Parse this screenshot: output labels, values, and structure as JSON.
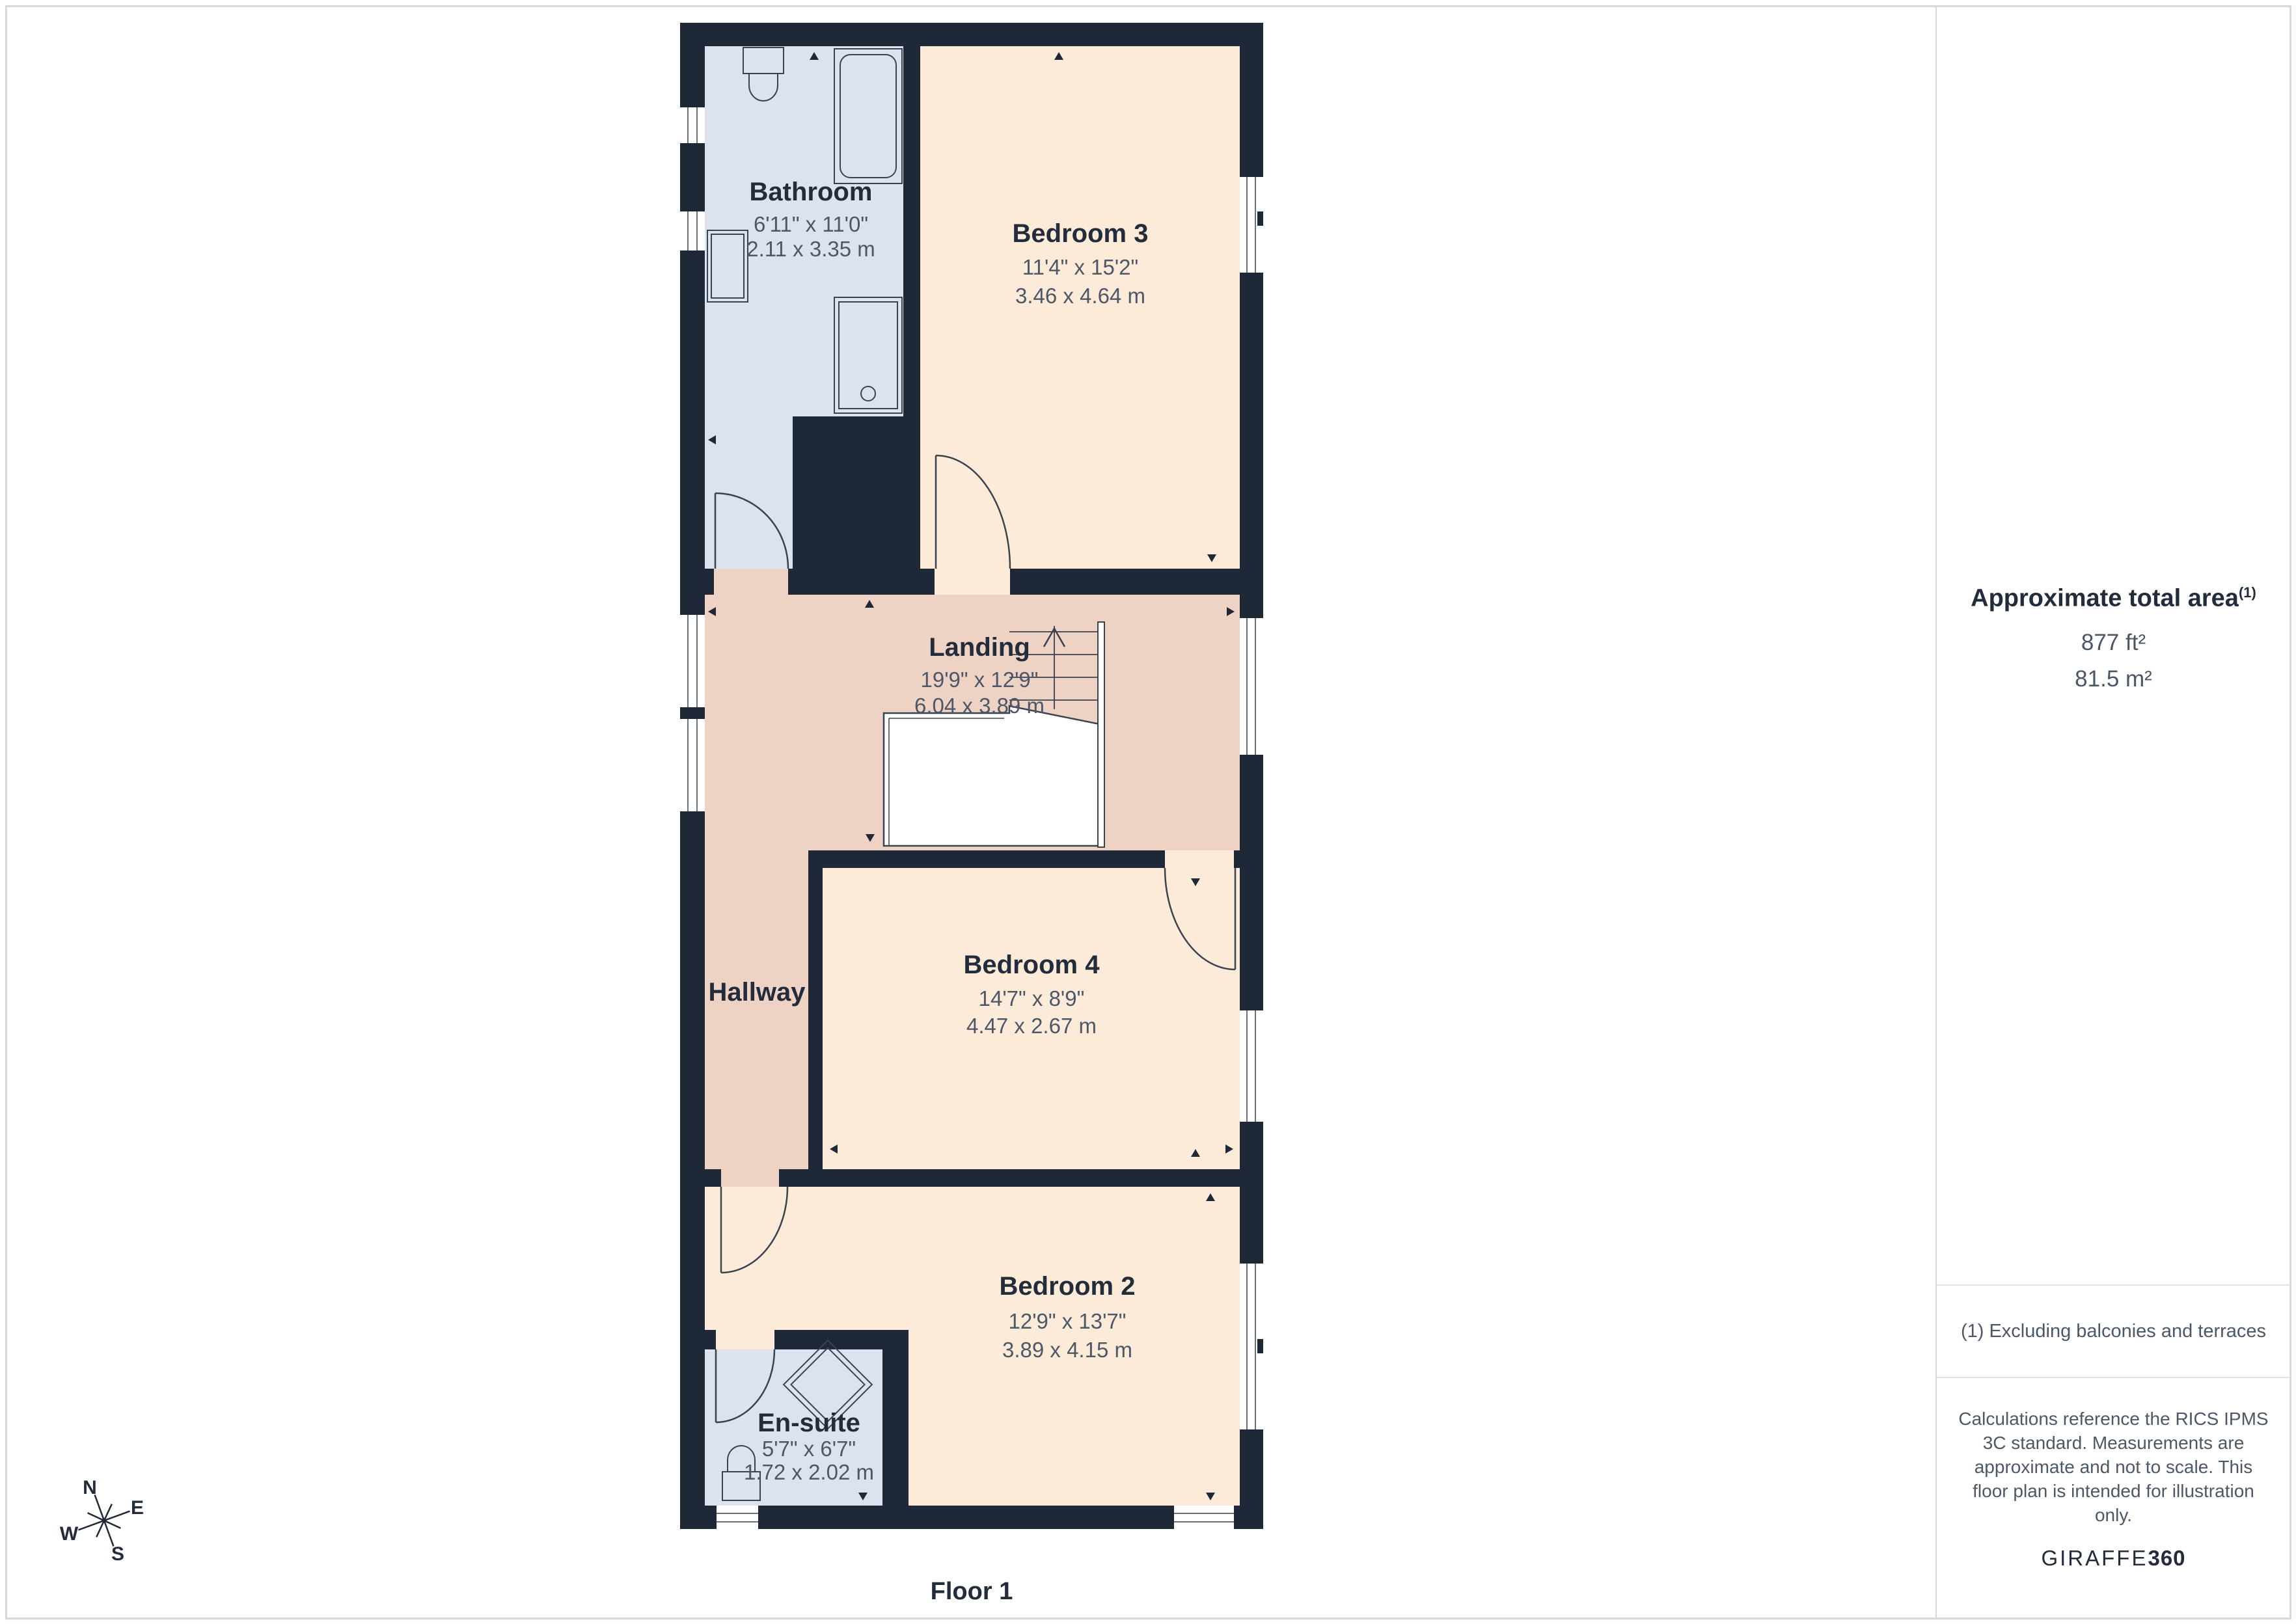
{
  "page": {
    "floor_label": "Floor 1"
  },
  "rooms": {
    "bathroom": {
      "name": "Bathroom",
      "imperial": "6'11\" x 11'0\"",
      "metric": "2.11 x 3.35 m"
    },
    "bedroom3": {
      "name": "Bedroom 3",
      "imperial": "11'4\" x 15'2\"",
      "metric": "3.46 x 4.64 m"
    },
    "landing": {
      "name": "Landing",
      "imperial": "19'9\" x 12'9\"",
      "metric": "6.04 x 3.89 m"
    },
    "hallway": {
      "name": "Hallway"
    },
    "bedroom4": {
      "name": "Bedroom 4",
      "imperial": "14'7\" x 8'9\"",
      "metric": "4.47 x 2.67 m"
    },
    "bedroom2": {
      "name": "Bedroom 2",
      "imperial": "12'9\" x 13'7\"",
      "metric": "3.89 x 4.15 m"
    },
    "ensuite": {
      "name": "En-suite",
      "imperial": "5'7\" x 6'7\"",
      "metric": "1.72 x 2.02 m"
    }
  },
  "compass": {
    "north": "N",
    "east": "E",
    "south": "S",
    "west": "W"
  },
  "sidebar": {
    "area_title": "Approximate total area",
    "area_title_sup": "(1)",
    "area_imperial": "877 ft²",
    "area_metric": "81.5 m²",
    "footnote": "(1) Excluding balconies and terraces",
    "disclaimer_lines": [
      "Calculations reference the RICS IPMS",
      "3C standard. Measurements are",
      "approximate and not to scale. This",
      "floor plan is intended for illustration",
      "only."
    ],
    "brand_name": "GIRAFFE",
    "brand_suffix": "360"
  },
  "colors": {
    "wall": "#1f2836",
    "bedroom_fill": "#fcebd9",
    "landing_fill": "#eed3c5",
    "bathroom_fill": "#dde3ee",
    "line": "#39424f",
    "title_text": "#232c3a",
    "dim_text": "#4d5768",
    "border": "#d8d8d8"
  }
}
